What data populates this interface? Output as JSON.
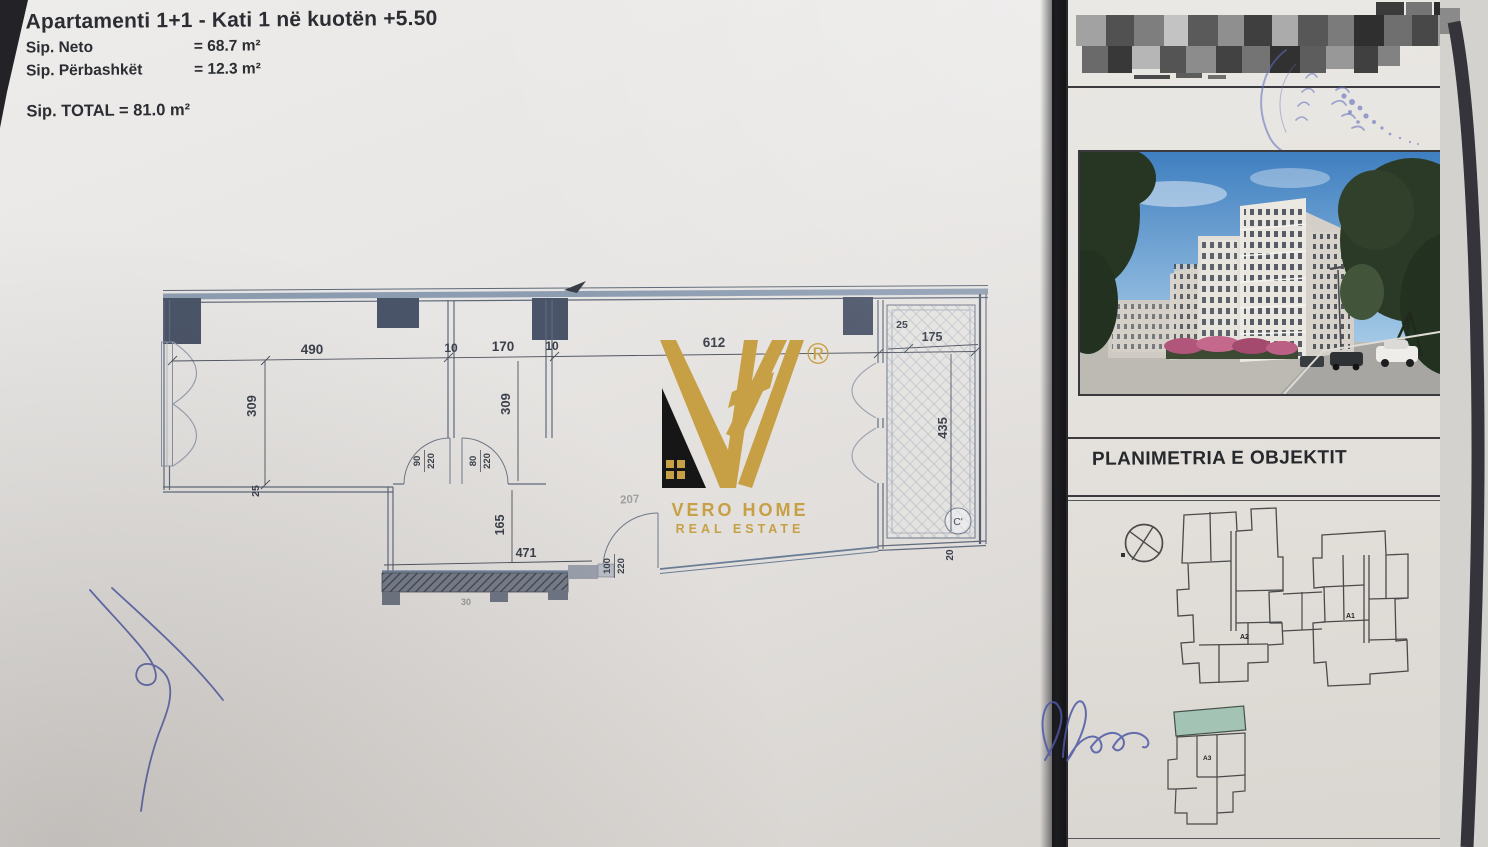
{
  "header": {
    "title": "Apartamenti  1+1 - Kati 1 në kuotën +5.50",
    "neto_label": "Sip. Neto",
    "neto_value": "= 68.7 m²",
    "perbashket_label": "Sip. Përbashkët",
    "perbashket_value": "= 12.3 m²",
    "total": "Sip. TOTAL = 81.0 m²"
  },
  "plan": {
    "top_dims": [
      "490",
      "10",
      "170",
      "10",
      "612"
    ],
    "left_height": "309",
    "mid_height": "309",
    "hall_height": "165",
    "hall_width": "471",
    "wall_25": "25",
    "faint_207": "207",
    "faint_30": "30",
    "balcony": {
      "offset": "25",
      "width": "175",
      "height": "435",
      "bottom": "20",
      "marker": "C'"
    },
    "doors": [
      {
        "w": "90",
        "h": "220"
      },
      {
        "w": "80",
        "h": "220"
      },
      {
        "w": "100",
        "h": "220"
      }
    ]
  },
  "logo": {
    "registered": "®",
    "name": "VERO HOME",
    "tagline": "REAL ESTATE"
  },
  "panel": {
    "section_title": "PLANIMETRIA E OBJEKTIT",
    "label_a1": "A1",
    "label_a2": "A2",
    "label_a3": "A3"
  },
  "colors": {
    "gold": "#c7a045",
    "wall_blue": "#8d9db1",
    "column_slate": "#4a5468",
    "highlight_green": "#a3c4b4",
    "ink_blue": "#4d58a6",
    "stamp_blue": "#5f6cbb"
  }
}
